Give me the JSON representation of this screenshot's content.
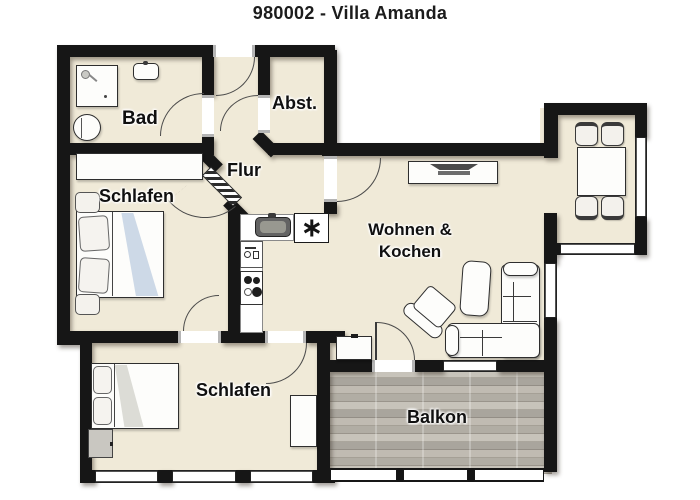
{
  "title": "980002 - Villa Amanda",
  "rooms": {
    "bad": {
      "label": "Bad"
    },
    "abstellraum": {
      "label": "Abst."
    },
    "flur": {
      "label": "Flur"
    },
    "schlafen_1": {
      "label": "Schlafen"
    },
    "wohnen_kochen": {
      "label_line1": "Wohnen &",
      "label_line2": "Kochen"
    },
    "schlafen_2": {
      "label": "Schlafen"
    },
    "balkon": {
      "label": "Balkon"
    }
  },
  "symbols": {
    "fridge_freezer_star": "✳"
  },
  "colors": {
    "floor": "#f0ead8",
    "wall": "#161616",
    "balcony_wood": "#bcb8ae",
    "blanket_blue": "#cdd9e7",
    "outline": "#2e2e2e"
  }
}
